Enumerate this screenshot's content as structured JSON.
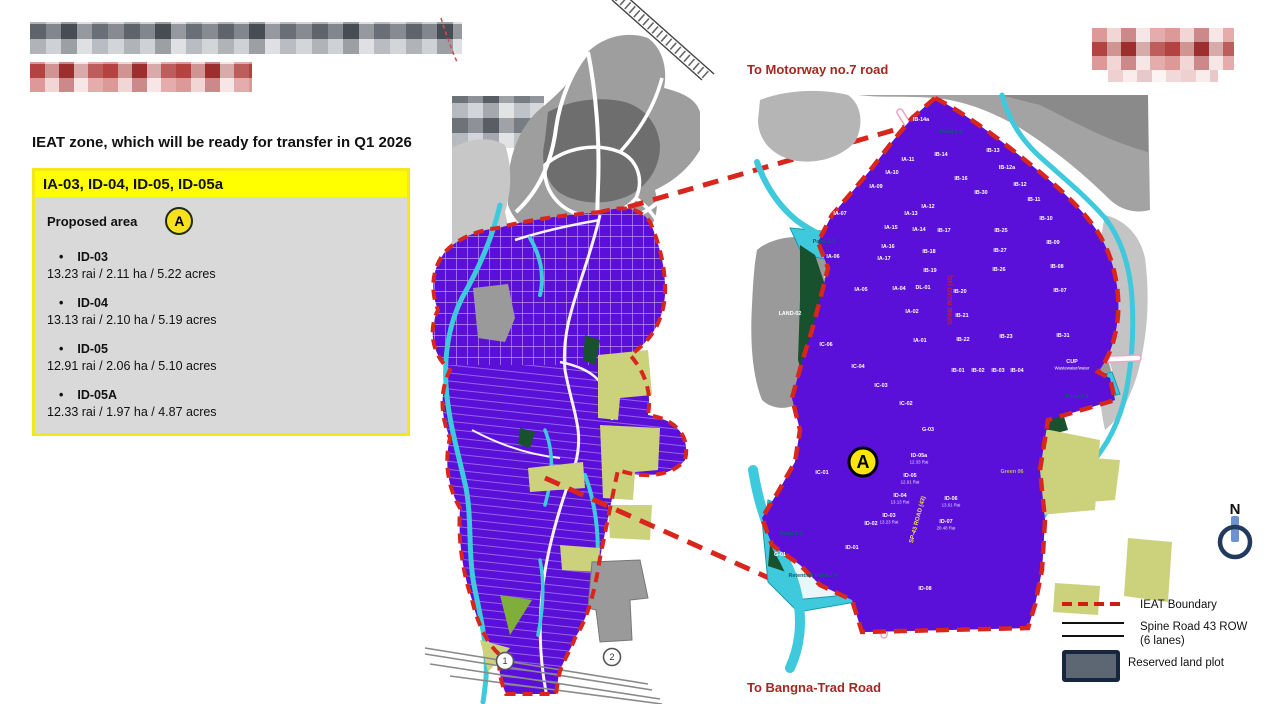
{
  "info_panel": {
    "heading": "IEAT zone, which will be ready for transfer in Q1 2026",
    "zone_title": "IA-03, ID-04, ID-05, ID-05a",
    "proposed_area_label": "Proposed area",
    "marker_label": "A",
    "items": [
      {
        "name": "ID-03",
        "area": "13.23 rai / 2.11 ha / 5.22 acres"
      },
      {
        "name": "ID-04",
        "area": "13.13 rai / 2.10 ha / 5.19 acres"
      },
      {
        "name": "ID-05",
        "area": "12.91 rai / 2.06 ha / 5.10 acres"
      },
      {
        "name": "ID-05A",
        "area": "12.33 rai / 1.97 ha / 4.87 acres"
      }
    ]
  },
  "map": {
    "to_top": "To Motorway no.7 road",
    "to_bottom": "To Bangna-Trad Road",
    "marker_a": "A",
    "north": "N",
    "overview_markers": [
      {
        "text": "1",
        "x": 505,
        "y": 661
      },
      {
        "text": "2",
        "x": 612,
        "y": 657
      }
    ],
    "road_labels": [
      {
        "text": "SPINE ROAD (43)",
        "x": 952,
        "y": 300,
        "rot": -90,
        "color": "#cc2020",
        "size": 6
      },
      {
        "text": "SP-43 ROAD (43)",
        "x": 919,
        "y": 520,
        "rot": -75,
        "color": "#f3e34b",
        "size": 6
      }
    ],
    "parcels": [
      {
        "label": "IA-11",
        "x": 908,
        "y": 161
      },
      {
        "label": "IA-10",
        "x": 892,
        "y": 174
      },
      {
        "label": "IA-09",
        "x": 876,
        "y": 188
      },
      {
        "label": "IA-07",
        "x": 840,
        "y": 215
      },
      {
        "label": "IA-06",
        "x": 833,
        "y": 258
      },
      {
        "label": "IA-05",
        "x": 861,
        "y": 291
      },
      {
        "label": "IB-14a",
        "x": 921,
        "y": 121
      },
      {
        "label": "Pond 2-2",
        "x": 951,
        "y": 133,
        "c": "pond"
      },
      {
        "label": "IB-14",
        "x": 941,
        "y": 156
      },
      {
        "label": "IB-13",
        "x": 993,
        "y": 152
      },
      {
        "label": "IB-12a",
        "x": 1007,
        "y": 169
      },
      {
        "label": "IB-12",
        "x": 1020,
        "y": 186
      },
      {
        "label": "IB-11",
        "x": 1034,
        "y": 201
      },
      {
        "label": "IB-10",
        "x": 1046,
        "y": 220
      },
      {
        "label": "IB-09",
        "x": 1053,
        "y": 244
      },
      {
        "label": "IB-08",
        "x": 1057,
        "y": 268
      },
      {
        "label": "IB-07",
        "x": 1060,
        "y": 292
      },
      {
        "label": "IB-16",
        "x": 961,
        "y": 180
      },
      {
        "label": "IB-30",
        "x": 981,
        "y": 194
      },
      {
        "label": "IA-12",
        "x": 928,
        "y": 208
      },
      {
        "label": "IA-13",
        "x": 911,
        "y": 215
      },
      {
        "label": "IA-14",
        "x": 919,
        "y": 231
      },
      {
        "label": "IA-15",
        "x": 891,
        "y": 229
      },
      {
        "label": "IB-17",
        "x": 944,
        "y": 232
      },
      {
        "label": "IB-25",
        "x": 1001,
        "y": 232
      },
      {
        "label": "IA-16",
        "x": 888,
        "y": 248
      },
      {
        "label": "IA-17",
        "x": 884,
        "y": 260
      },
      {
        "label": "IB-18",
        "x": 929,
        "y": 253
      },
      {
        "label": "IB-27",
        "x": 1000,
        "y": 252
      },
      {
        "label": "IB-19",
        "x": 930,
        "y": 272
      },
      {
        "label": "IB-26",
        "x": 999,
        "y": 271
      },
      {
        "label": "IA-04",
        "x": 899,
        "y": 290
      },
      {
        "label": "DL-01",
        "x": 923,
        "y": 289
      },
      {
        "label": "IB-20",
        "x": 960,
        "y": 293
      },
      {
        "label": "IA-02",
        "x": 912,
        "y": 313
      },
      {
        "label": "IB-21",
        "x": 962,
        "y": 317
      },
      {
        "label": "IA-01",
        "x": 920,
        "y": 342
      },
      {
        "label": "IB-22",
        "x": 963,
        "y": 341
      },
      {
        "label": "IB-23",
        "x": 1006,
        "y": 338
      },
      {
        "label": "IB-31",
        "x": 1063,
        "y": 337
      },
      {
        "label": "IB-01",
        "x": 958,
        "y": 372
      },
      {
        "label": "IB-02",
        "x": 978,
        "y": 372
      },
      {
        "label": "IB-03",
        "x": 998,
        "y": 372
      },
      {
        "label": "IB-04",
        "x": 1017,
        "y": 372
      },
      {
        "label": "CUP",
        "sub": "Wastewater/water",
        "x": 1072,
        "y": 363,
        "c": "grayl"
      },
      {
        "label": "Pond 2-4",
        "x": 1077,
        "y": 398,
        "c": "pond"
      },
      {
        "label": "LAND-02",
        "x": 790,
        "y": 315,
        "c": "grayl"
      },
      {
        "label": "Pond 2-3",
        "x": 824,
        "y": 243,
        "c": "pond"
      },
      {
        "label": "IC-06",
        "x": 826,
        "y": 346
      },
      {
        "label": "IC-04",
        "x": 858,
        "y": 368
      },
      {
        "label": "IC-03",
        "x": 881,
        "y": 387
      },
      {
        "label": "IC-02",
        "x": 906,
        "y": 405
      },
      {
        "label": "IC-01",
        "x": 822,
        "y": 474
      },
      {
        "label": "G-03",
        "x": 928,
        "y": 431
      },
      {
        "label": "G-01",
        "x": 780,
        "y": 556
      },
      {
        "label": "ID-05a",
        "sub": "12.33 Rai",
        "x": 919,
        "y": 457
      },
      {
        "label": "ID-05",
        "sub": "12.91 Rai",
        "x": 910,
        "y": 477
      },
      {
        "label": "ID-04",
        "sub": "13.13 Rai",
        "x": 900,
        "y": 497
      },
      {
        "label": "ID-03",
        "sub": "13.23 Rai",
        "x": 889,
        "y": 517
      },
      {
        "label": "ID-02",
        "x": 871,
        "y": 525
      },
      {
        "label": "ID-01",
        "x": 852,
        "y": 549
      },
      {
        "label": "ID-06",
        "sub": "13.61 Rai",
        "x": 951,
        "y": 500
      },
      {
        "label": "ID-07",
        "sub": "20.48 Rai",
        "x": 946,
        "y": 523
      },
      {
        "label": "ID-08",
        "x": 925,
        "y": 590
      },
      {
        "label": "Pond 2-1",
        "x": 791,
        "y": 535,
        "c": "pond"
      },
      {
        "label": "Retention Pond 2-4",
        "x": 813,
        "y": 577,
        "c": "pond"
      },
      {
        "label": "Green 06",
        "x": 1012,
        "y": 473,
        "c": "olivel"
      }
    ]
  },
  "legend": {
    "items": [
      {
        "label": "IEAT Boundary"
      },
      {
        "label": "Spine Road 43 ROW\n(6 lanes)"
      },
      {
        "label": "Reserved land plot"
      }
    ]
  }
}
